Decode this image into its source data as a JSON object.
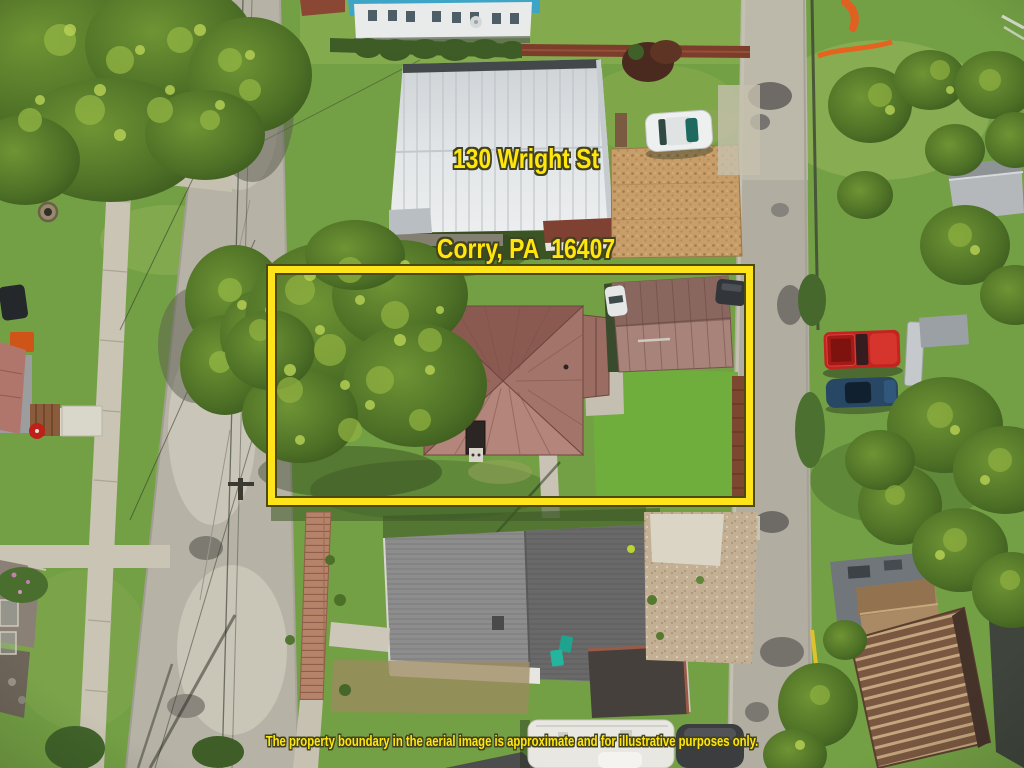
{
  "overlay": {
    "address_line1": "130 Wright St",
    "address_line2": "Corry, PA  16407",
    "disclaimer": "The property boundary in the aerial image is approximate and for illustrative purposes only.",
    "text_color": "#ffe60d",
    "text_outline_color": "#42421f"
  },
  "boundary_box": {
    "color": "#ffe419",
    "outline_color": "#4c4a14"
  },
  "scene_colors": {
    "grass": "#74a045",
    "street_concrete": "#b6b2a5",
    "alley_gravel": "#b1ada0",
    "subject_roof": "#a3746a",
    "garage_roof": "#9b7a6f",
    "white_metal_roof": "#e0e3e6",
    "blue_roof": "#3fa5c6",
    "gray_shingle_roof": "#7b7c7b",
    "carport_tan": "#c79e6a",
    "red_truck": "#c32420",
    "blue_car": "#274764",
    "safety_orange": "#e4631f"
  }
}
